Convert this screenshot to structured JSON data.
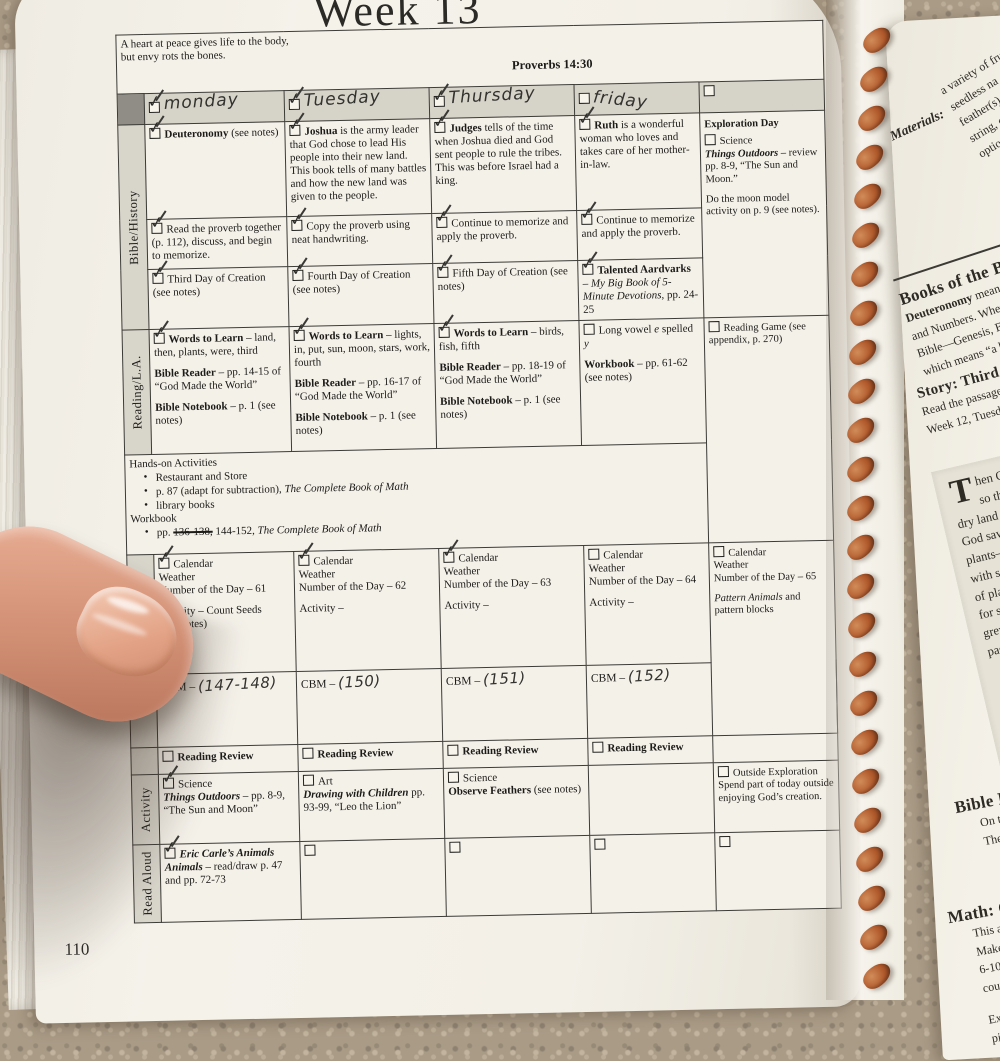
{
  "page": {
    "week_title": "Week 13",
    "page_number": "110"
  },
  "quote": {
    "line1": "A heart at peace gives life to the body,",
    "line2": "but envy rots the bones.",
    "ref": "Proverbs 14:30"
  },
  "day_headers": {
    "mon": "monday",
    "tue": "Tuesday",
    "thu": "Thursday",
    "fri": "friday"
  },
  "row_labels": {
    "bible": "Bible/History",
    "reading": "Reading/L.A.",
    "math": "Math – Subtraction",
    "activity": "Activity",
    "read_aloud": "Read Aloud"
  },
  "checks": {
    "hdr_mon": true,
    "hdr_tue": true,
    "hdr_thu": true,
    "hdr_fri": false,
    "hdr_x": false,
    "b1_mon": true,
    "b1_tue": true,
    "b1_thu": true,
    "b1_fri": true,
    "b2_mon": true,
    "b2_tue": true,
    "b2_thu": true,
    "b2_fri": true,
    "b3_mon": true,
    "b3_tue": true,
    "b3_thu": true,
    "b3_fri": true,
    "exp_sci": false,
    "rd_mon": true,
    "rd_tue": true,
    "rd_thu": true,
    "rd_fri": false,
    "game": false,
    "cal_mon": true,
    "cal_tue": true,
    "cal_thu": true,
    "cal_fri": false,
    "cal_x": false,
    "rv_mon": false,
    "rv_tue": false,
    "rv_thu": false,
    "rv_fri": false,
    "act_mon": true,
    "act_tue": false,
    "act_thu": false,
    "act_x": false,
    "ra_mon": true,
    "ra_tue": false,
    "ra_thu": false,
    "ra_fri": false,
    "ra_x": false
  },
  "bible": {
    "r1": {
      "mon_lead": "Deuteronomy",
      "mon_rest": " (see notes)",
      "tue_lead": "Joshua",
      "tue_rest": " is the army leader that God chose to lead His people into their new land. This book tells of many battles and how the new land was given to the people.",
      "thu_lead": "Judges",
      "thu_rest": " tells of the time when Joshua died and God sent people to rule the tribes. This was before Israel had a king.",
      "fri_lead": "Ruth",
      "fri_rest": " is a wonderful woman who loves and takes care of her mother-in-law."
    },
    "r2": {
      "mon": "Read the proverb together (p. 112), discuss, and begin to memorize.",
      "tue": "Copy the proverb using neat handwriting.",
      "thu": "Continue to memorize and apply the proverb.",
      "fri": "Continue to memorize and apply the proverb."
    },
    "r3": {
      "mon": "Third Day of Creation (see notes)",
      "tue": "Fourth Day of Creation (see notes)",
      "thu": "Fifth Day of Creation (see notes)",
      "fri_lead": "Talented Aardvarks",
      "fri_mid": " – ",
      "fri_title": "My Big Book of 5-Minute Devotions",
      "fri_rest": ", pp. 24-25"
    },
    "exploration": {
      "title": "Exploration Day",
      "item_label": "Science",
      "book": "Things Outdoors",
      "book_rest": " – review pp. 8-9, “The Sun and Moon.”",
      "note": "Do the moon model activity on p. 9 (see notes)."
    }
  },
  "reading": {
    "mon": {
      "words_lead": "Words to Learn",
      "words_rest": " – land, then, plants, were, third",
      "reader_lead": "Bible Reader",
      "reader_rest": " – pp. 14-15 of “God Made the World”",
      "notebook_lead": "Bible Notebook",
      "notebook_rest": " – p. 1 (see notes)"
    },
    "tue": {
      "words_lead": "Words to Learn",
      "words_rest": " – lights, in, put, sun, moon, stars, work, fourth",
      "reader_lead": "Bible Reader",
      "reader_rest": " – pp. 16-17 of “God Made the World”",
      "notebook_lead": "Bible Notebook",
      "notebook_rest": " – p. 1 (see notes)"
    },
    "thu": {
      "words_lead": "Words to Learn",
      "words_rest": " – birds, fish, fifth",
      "reader_lead": "Bible Reader",
      "reader_rest": " – pp. 18-19 of “God Made the World”",
      "notebook_lead": "Bible Notebook",
      "notebook_rest": " – p. 1 (see notes)"
    },
    "fri": {
      "p1": "Long vowel ",
      "e": "e",
      "p2": " spelled ",
      "y": "y",
      "workbook_lead": "Workbook",
      "workbook_rest": " – pp. 61-62 (see notes)"
    },
    "game": "Reading Game (see appendix, p. 270)"
  },
  "hands_on": {
    "title": "Hands-on Activities",
    "b1": "Restaurant and Store",
    "b2_pre": "p. 87 (adapt for subtraction), ",
    "b2_title": "The Complete Book of Math",
    "b3": "library books",
    "workbook": "Workbook",
    "b4_pre": "pp. ",
    "b4_struck": "136-138,",
    "b4_mid": " 144-152, ",
    "b4_title": "The Complete Book of Math"
  },
  "math": {
    "mon": {
      "l1": "Calendar",
      "l2": "Weather",
      "l3": "Number of the Day – 61",
      "act": "Activity – Count Seeds",
      "act2": "(see notes)"
    },
    "tue": {
      "l1": "Calendar",
      "l2": "Weather",
      "l3": "Number of the Day – 62",
      "act": "Activity –"
    },
    "thu": {
      "l1": "Calendar",
      "l2": "Weather",
      "l3": "Number of the Day – 63",
      "act": "Activity –"
    },
    "fri": {
      "l1": "Calendar",
      "l2": "Weather",
      "l3": "Number of the Day – 64",
      "act": "Activity –"
    },
    "extra": {
      "l1": "Calendar",
      "l2": "Weather",
      "l3": "Number of the Day – 65",
      "pattern_title": "Pattern Animals",
      "pattern_rest": " and pattern blocks"
    },
    "cbm_label": "CBM –",
    "cbm": {
      "mon": "(147-148)",
      "tue": "(150)",
      "thu": "(151)",
      "fri": "(152)"
    }
  },
  "review": {
    "label": "Reading Review"
  },
  "activity": {
    "mon": {
      "cat": "Science",
      "book": "Things Outdoors",
      "rest": " – pp. 8-9, “The Sun and Moon”"
    },
    "tue": {
      "cat": "Art",
      "book": "Drawing with Children",
      "rest": " pp. 93-99, “Leo the Lion”"
    },
    "thu": {
      "cat": "Science",
      "bold": "Observe Feathers",
      "rest": " (see notes)"
    },
    "extra": {
      "title": "Outside Exploration",
      "rest": "Spend part of today outside enjoying God’s creation."
    }
  },
  "read_aloud": {
    "mon_title": "Eric Carle’s Animals Animals",
    "mon_rest": " – read/draw p. 47 and pp. 72-73"
  },
  "right_page": {
    "materials_label": "Materials:",
    "materials_lines": [
      "a variety of fru",
      "seedless na",
      "feather(s), ma",
      "string, clay (b",
      "optional—fla"
    ],
    "books_heading": "Books of the Bible",
    "books_line1_lead": "Deuteronomy",
    "books_line1_rest": " means",
    "books_lines": [
      "and Numbers. Wher",
      "Bible—Genesis, Exo",
      "which means “a boo"
    ],
    "story_heading": "Story: Third Day o",
    "story_lines": [
      "Read the passage p",
      "Week 12, Tuesday,"
    ],
    "quote_dropcap": "T",
    "quote_lines": [
      "hen G",
      "so th",
      "dry land",
      "God saw",
      "plants—",
      "with see",
      "of plant",
      "for seed",
      "grew it",
      "passed"
    ],
    "notebook_heading": "Bible Notebo",
    "notebook_lines": [
      "On the botto",
      "Then have h"
    ],
    "math_heading": "Math: Count",
    "math_lines": [
      "This activi",
      "Make a ch",
      "6-10, 11-1",
      "counted i"
    ],
    "math_lines2": [
      "Extra cha",
      "piles. You"
    ]
  }
}
